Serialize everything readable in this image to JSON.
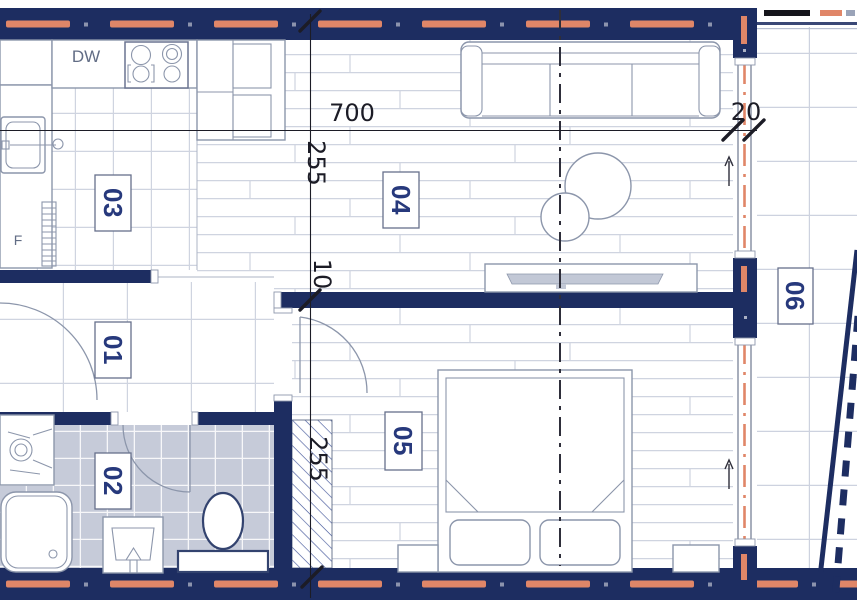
{
  "room_labels": {
    "hall": "01",
    "bathroom": "02",
    "kitchen": "03",
    "living_room": "04",
    "bedroom": "05",
    "balcony": "06"
  },
  "dimensions": {
    "top_width": "700",
    "exterior_wall_thickness": "20",
    "living_room_depth": "255",
    "partition_thickness": "10",
    "bedroom_depth": "255"
  },
  "annotations": {
    "dishwasher": "DW",
    "fridge": "F"
  },
  "colors": {
    "wall": "#1d2d61",
    "accent": "#e08668",
    "label": "#27397c",
    "dim": "#1c1c26",
    "line": "#8c96ab",
    "floorline": "#cfd4e0",
    "bathfloor": "#c6cbd9"
  }
}
